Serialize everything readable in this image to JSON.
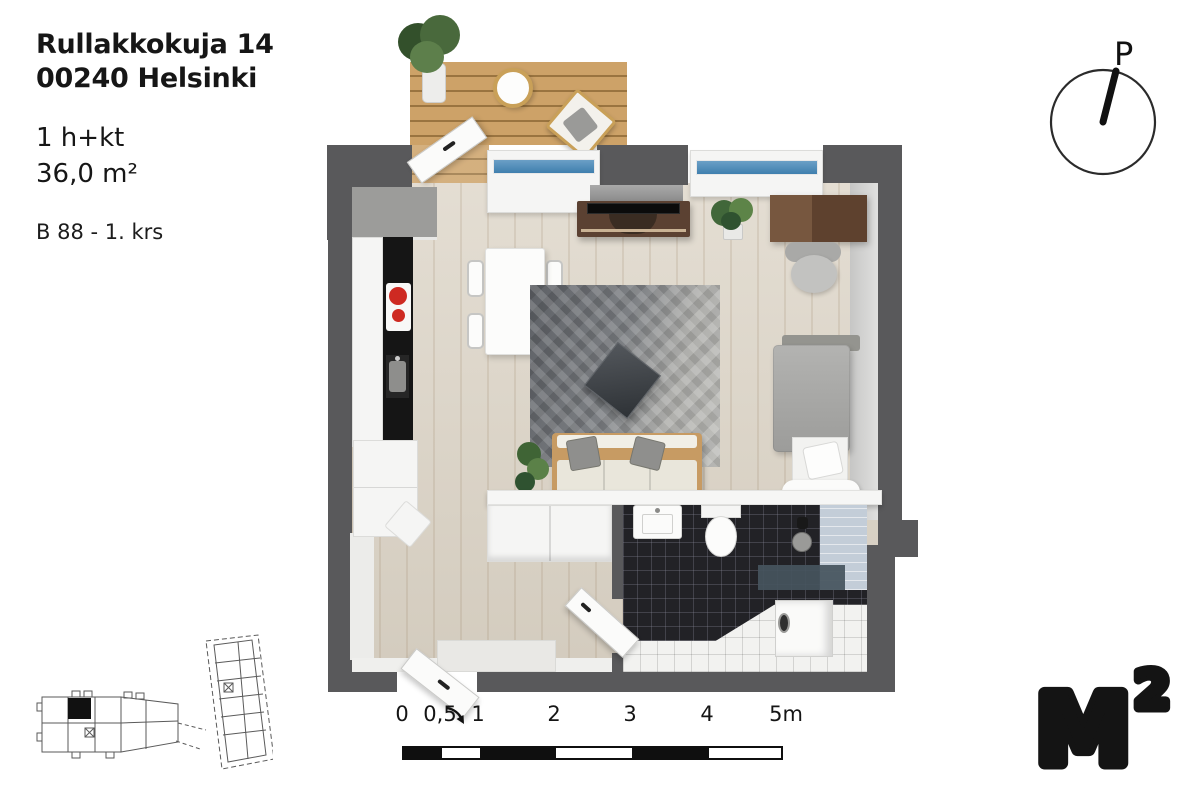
{
  "header": {
    "address_line1": "Rullakkokuja 14",
    "address_line2": "00240 Helsinki",
    "apartment_type": "1 h+kt",
    "area": "36,0 m²",
    "unit_floor": "B 88 - 1. krs"
  },
  "compass": {
    "north_label": "P"
  },
  "scale_bar": {
    "labels": [
      "0",
      "0,5",
      "1",
      "2",
      "3",
      "4",
      "5m"
    ]
  },
  "logo": {
    "letter": "M",
    "superscript": "2"
  },
  "colors": {
    "wall": "#59595b",
    "wood_floor": "#dcd4c6",
    "deck_wood": "#c99e63",
    "window_glass": "#4a86b4",
    "rug_dark": "#63666b",
    "rug_light": "#bcbcb8",
    "bathroom_tile_dark": "#222226",
    "bathroom_tile_light": "#f2f2f0",
    "cooktop_burner_red": "#ce2a22",
    "brand_black": "#141414"
  }
}
